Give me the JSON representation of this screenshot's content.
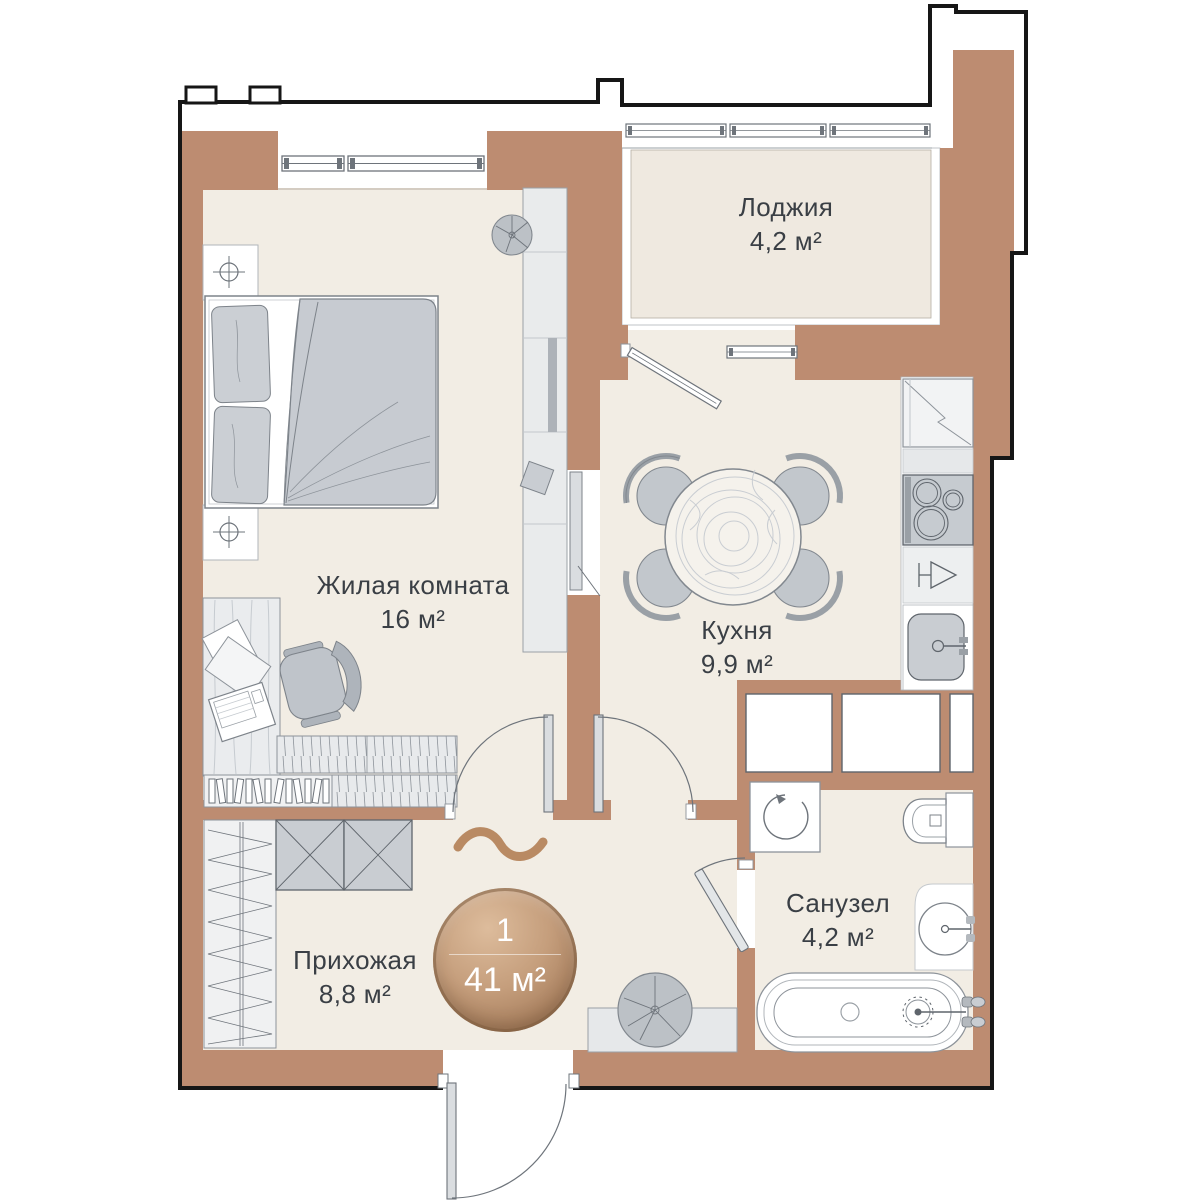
{
  "plan": {
    "type": "floor-plan",
    "rooms": [
      {
        "name": "Жилая комната",
        "area": "16 м²"
      },
      {
        "name": "Кухня",
        "area": "9,9 м²"
      },
      {
        "name": "Лоджия",
        "area": "4,2 м²"
      },
      {
        "name": "Санузел",
        "area": "4,2 м²"
      },
      {
        "name": "Прихожая",
        "area": "8,8 м²"
      }
    ],
    "badge": {
      "rooms_count": "1",
      "total_area": "41 м²"
    },
    "icons": [
      "double-bed",
      "wardrobe",
      "desk",
      "office-chair",
      "laptop",
      "papers",
      "bookshelf",
      "dresser",
      "dining-table",
      "chair",
      "plant",
      "fridge",
      "stove",
      "wine-glass",
      "kitchen-sink",
      "washing-machine",
      "toilet",
      "washbasin",
      "bathtub",
      "door-swing",
      "window",
      "ceiling-light",
      "decor-squiggle"
    ],
    "colors": {
      "wall": "#BD8C71",
      "outline": "#161616",
      "floor": "#F2EDE4",
      "loggia_floor": "#EFE9E0",
      "furniture_gray": "#C6CAD0",
      "furniture_light": "#E9EBEC",
      "stroke": "#6E747B",
      "badge_light": "#DCBA9A",
      "badge_dark": "#9F7655",
      "text": "#3A3F45",
      "accent_wood": "#B98A63"
    }
  }
}
